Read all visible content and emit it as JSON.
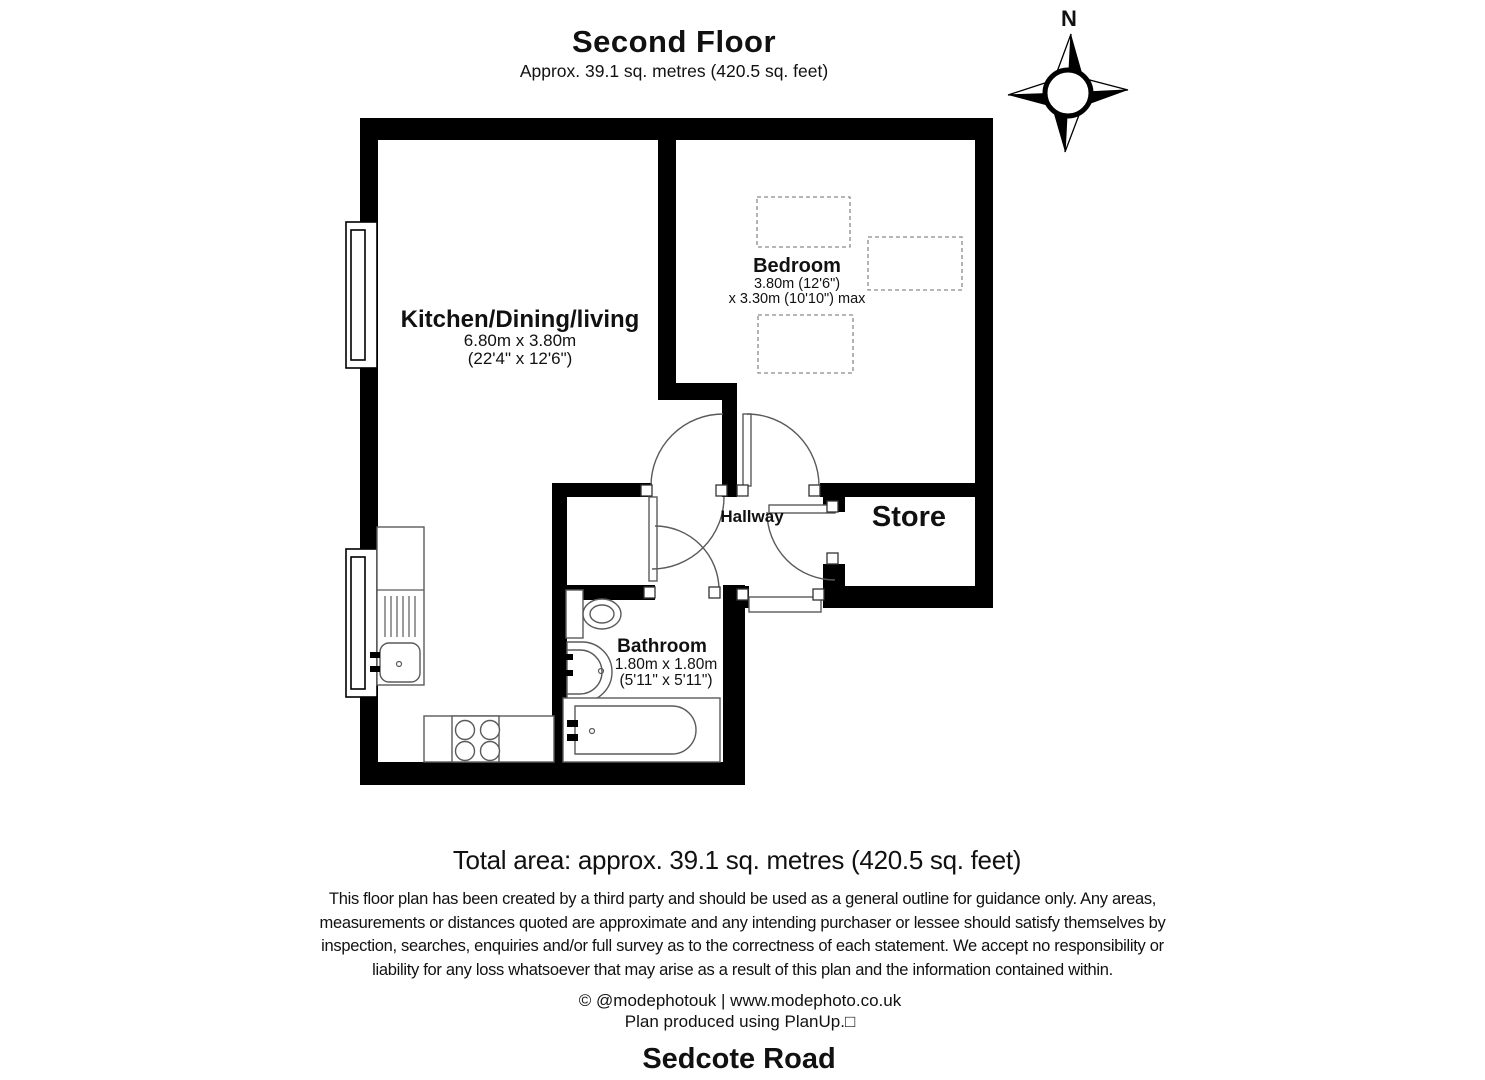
{
  "header": {
    "title": "Second Floor",
    "subtitle": "Approx. 39.1 sq. metres (420.5 sq. feet)"
  },
  "compass": {
    "north_label": "N"
  },
  "rooms": {
    "kitchen": {
      "name": "Kitchen/Dining/living",
      "dim_metric": "6.80m x 3.80m",
      "dim_imperial": "(22'4\" x 12'6\")"
    },
    "bedroom": {
      "name": "Bedroom",
      "dim_line1": "3.80m (12'6\")",
      "dim_line2": "x 3.30m (10'10\") max"
    },
    "hallway": {
      "name": "Hallway"
    },
    "store": {
      "name": "Store"
    },
    "bathroom": {
      "name": "Bathroom",
      "dim_metric": "1.80m x 1.80m",
      "dim_imperial": "(5'11\" x 5'11\")"
    }
  },
  "footer": {
    "total_area": "Total area: approx. 39.1 sq. metres (420.5 sq. feet)",
    "disclaimer_lines": [
      "This floor plan has been created by a third party and should be used as a general outline for guidance only. Any areas,",
      "measurements or distances quoted are approximate and any intending purchaser or lessee should satisfy themselves by",
      "inspection, searches, enquiries and/or full survey as to the correctness of each statement. We accept no responsibility or",
      "liability for any loss whatsoever that may arise as a result of this plan and the information contained within."
    ],
    "credit": "© @modephotouk | www.modephoto.co.uk",
    "produced": "Plan produced using PlanUp.□",
    "address": "Sedcote Road"
  }
}
